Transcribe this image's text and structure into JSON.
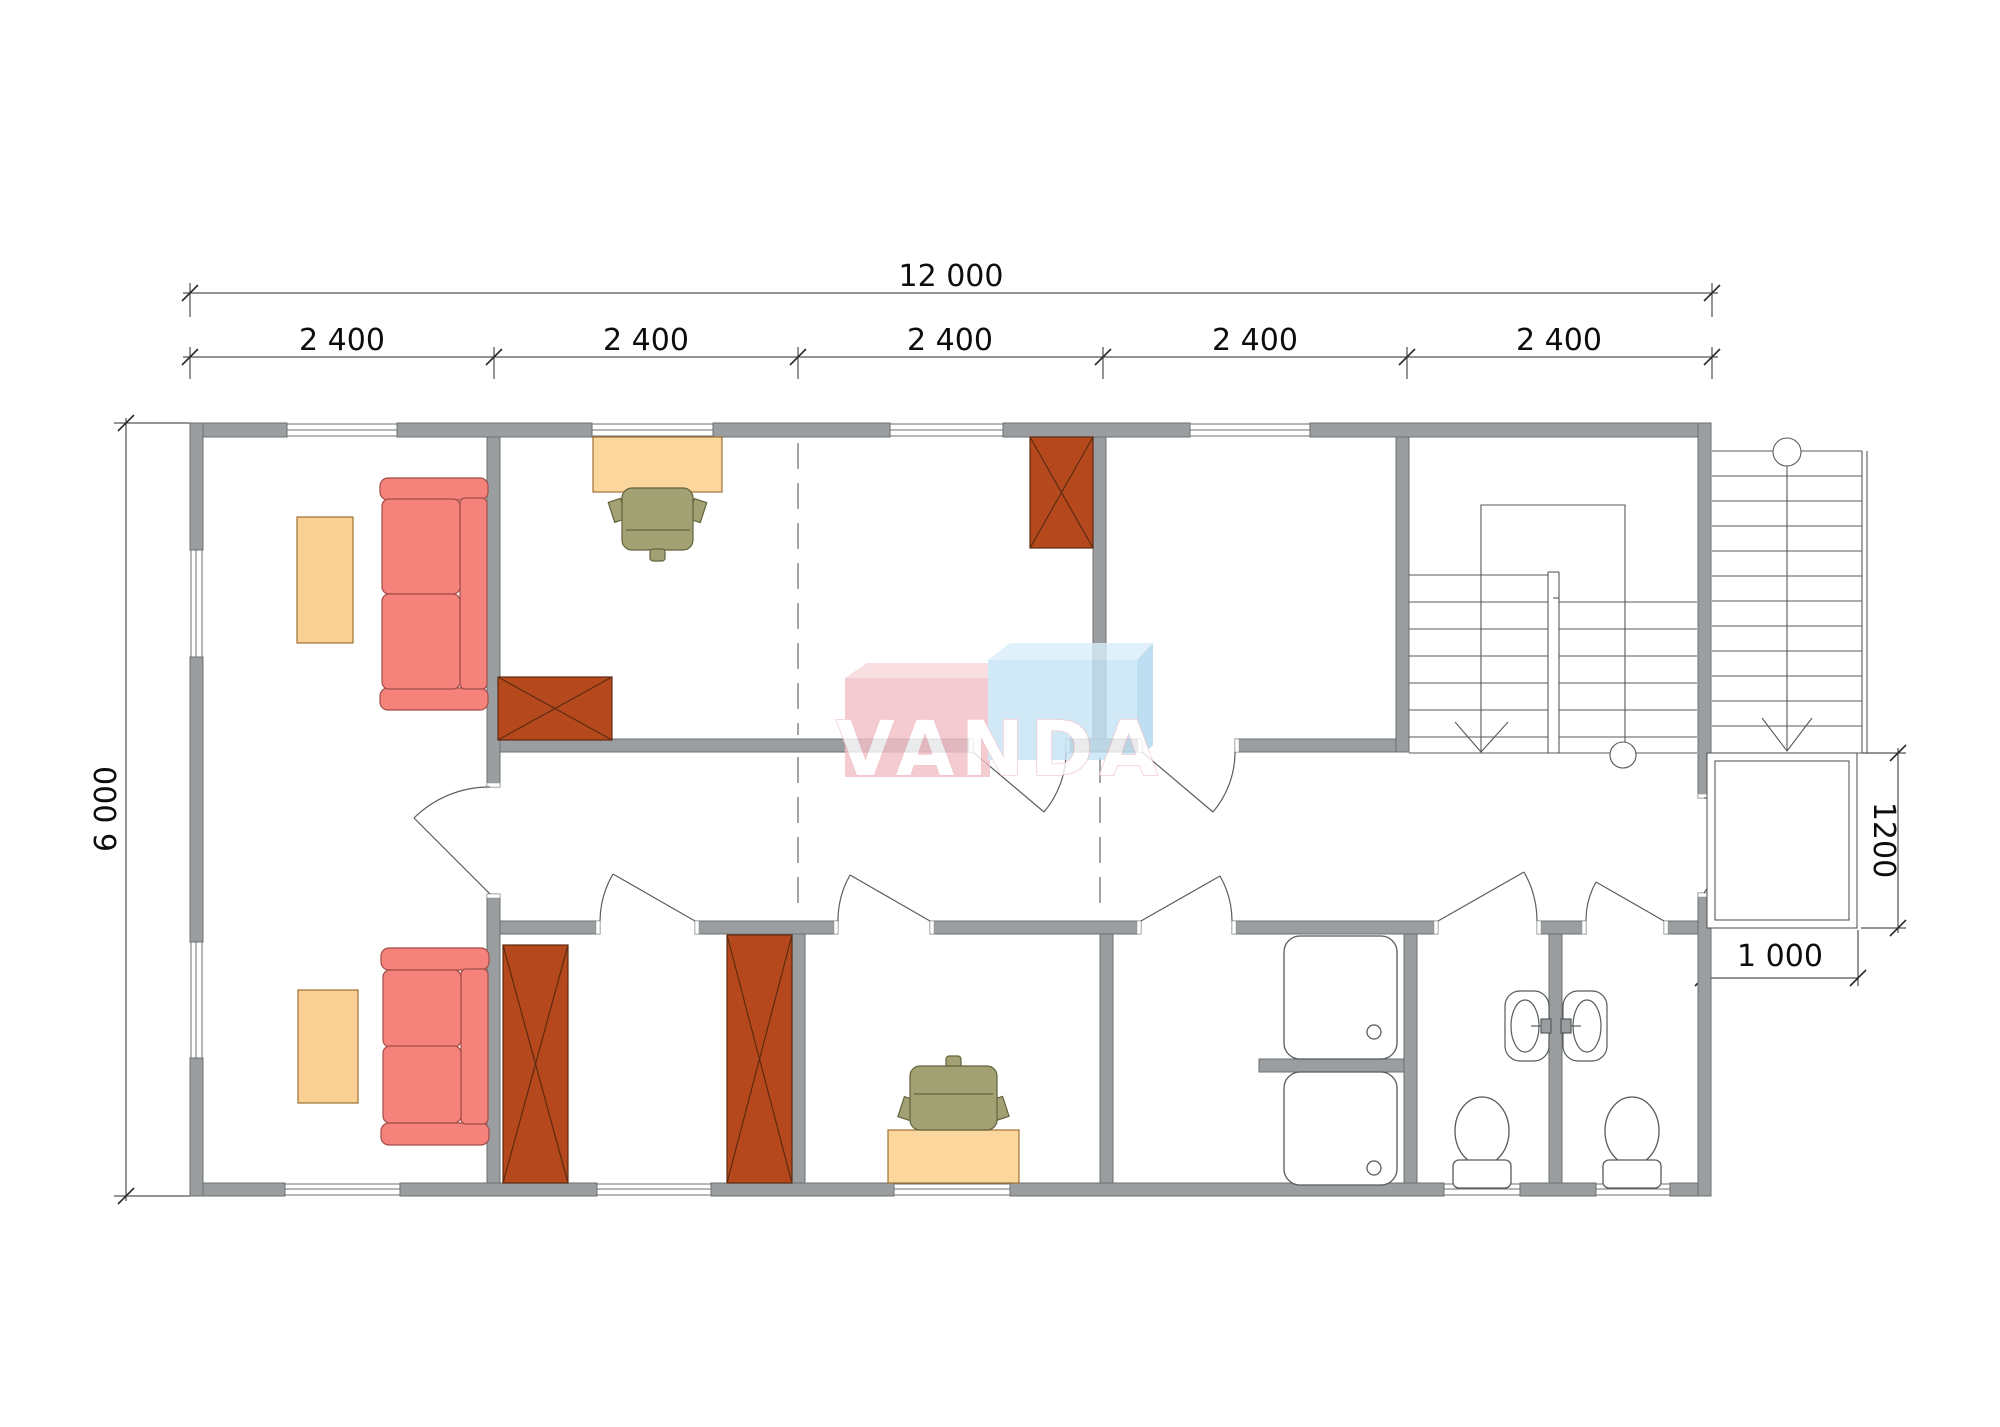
{
  "watermark": {
    "text": "VANDA",
    "pink_box_color": "#f3bfc7",
    "blue_box_color": "#c6e4f6"
  },
  "dimensions": {
    "total_width": "12 000",
    "modules": [
      "2 400",
      "2 400",
      "2 400",
      "2 400",
      "2 400"
    ],
    "total_height": "6 000",
    "porch_depth": "1200",
    "porch_width": "1 000"
  },
  "palette": {
    "wall_fill": "#9a9ea0",
    "wall_edge": "#6c7071",
    "sofa_fill": "#f5837c",
    "table_fill": "#fbd095",
    "wardrobe_fill": "#b5491d",
    "chair_fill": "#a2a173",
    "fixture_line": "#565a5b",
    "dimension_line": "#1a1a1a"
  },
  "legend": {
    "furniture_symbols": [
      "sofa",
      "coffee-table",
      "desk",
      "office-chair",
      "wardrobe",
      "shower-tray",
      "wash-basin",
      "toilet"
    ],
    "circulation_symbols": [
      "internal-u-stair",
      "external-stair",
      "porch",
      "door-swing",
      "window",
      "modular-grid-dashed-line"
    ]
  }
}
